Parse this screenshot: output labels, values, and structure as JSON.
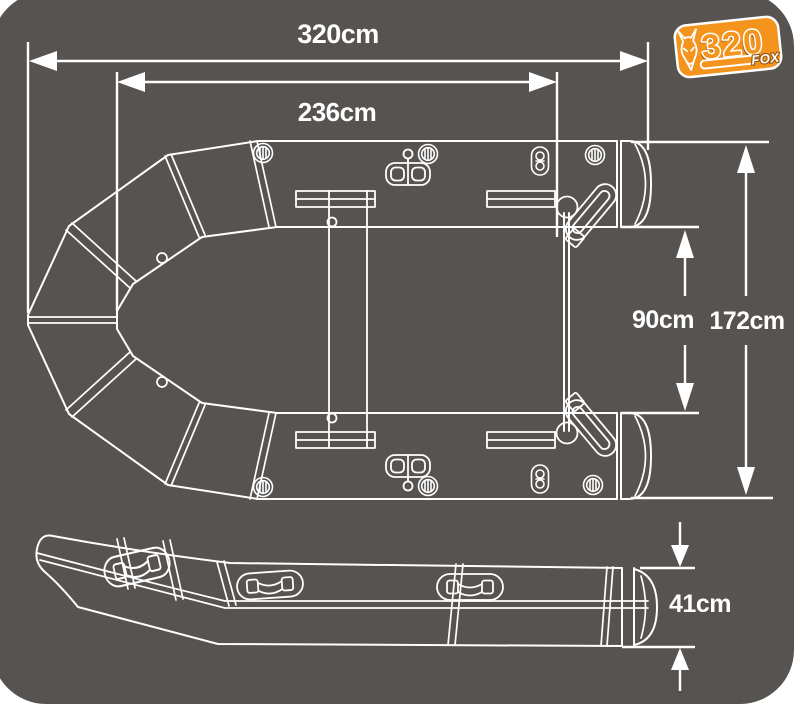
{
  "canvas": {
    "background": "#ffffff",
    "card_color": "#565350",
    "line_color": "#ffffff"
  },
  "logo": {
    "model": "320",
    "brand": "FOX",
    "accent_color": "#f4941d",
    "shadow_color": "#9a5a16"
  },
  "dimensions": {
    "overall_length": "320cm",
    "inner_length": "236cm",
    "inner_width": "90cm",
    "overall_width": "172cm",
    "tube_height": "41cm"
  }
}
